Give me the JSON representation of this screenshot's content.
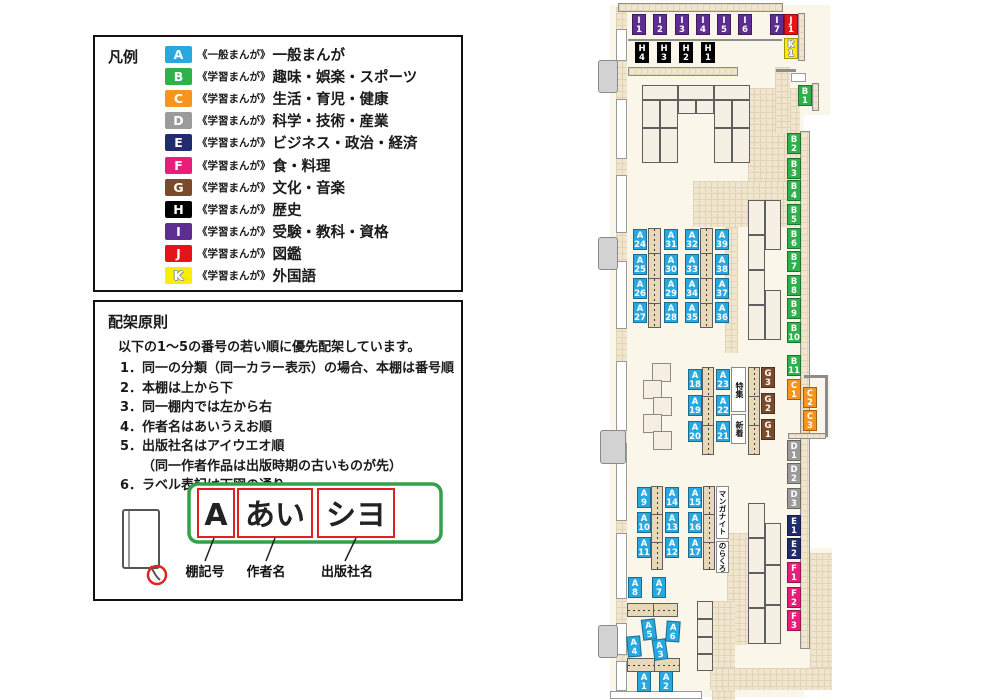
{
  "legend": {
    "title": "凡例",
    "items": [
      {
        "code": "A",
        "color": "#29a8e0",
        "type": "《一般まんが》",
        "category": "一般まんが"
      },
      {
        "code": "B",
        "color": "#2eb14b",
        "type": "《学習まんが》",
        "category": "趣味・娯楽・スポーツ"
      },
      {
        "code": "C",
        "color": "#f7941d",
        "type": "《学習まんが》",
        "category": "生活・育児・健康"
      },
      {
        "code": "D",
        "color": "#9b9b9b",
        "type": "《学習まんが》",
        "category": "科学・技術・産業"
      },
      {
        "code": "E",
        "color": "#202c6b",
        "type": "《学習まんが》",
        "category": "ビジネス・政治・経済"
      },
      {
        "code": "F",
        "color": "#e81f7a",
        "type": "《学習まんが》",
        "category": "食・料理"
      },
      {
        "code": "G",
        "color": "#7b4a2b",
        "type": "《学習まんが》",
        "category": "文化・音楽"
      },
      {
        "code": "H",
        "color": "#000000",
        "type": "《学習まんが》",
        "category": "歴史"
      },
      {
        "code": "I",
        "color": "#5e2d91",
        "type": "《学習まんが》",
        "category": "受験・教科・資格"
      },
      {
        "code": "J",
        "color": "#e7131b",
        "type": "《学習まんが》",
        "category": "図鑑"
      },
      {
        "code": "K",
        "color": "#f9ee00",
        "type": "《学習まんが》",
        "category": "外国語"
      }
    ]
  },
  "principles": {
    "title": "配架原則",
    "intro": "以下の1～5の番号の若い順に優先配架しています。",
    "rules": [
      {
        "num": "1．",
        "text": "同一の分類（同一カラー表示）の場合、本棚は番号順"
      },
      {
        "num": "2．",
        "text": "本棚は上から下"
      },
      {
        "num": "3．",
        "text": "同一棚内では左から右"
      },
      {
        "num": "4．",
        "text": "作者名はあいうえお順"
      },
      {
        "num": "5．",
        "text": "出版社名はアイウエオ順",
        "note": "（同一作者作品は出版時期の古いものが先）"
      },
      {
        "num": "6．",
        "text": "ラベル表記は下図の通り"
      }
    ]
  },
  "label_diagram": {
    "boxes": [
      "A",
      "あい",
      "シヨ"
    ],
    "captions": [
      "棚記号",
      "作者名",
      "出版社名"
    ]
  },
  "map": {
    "area_labels": [
      "特集",
      "新着",
      "マンガナイト",
      "のらくろ"
    ],
    "shelf_labels": [
      "A1",
      "A2",
      "A3",
      "A4",
      "A5",
      "A6",
      "A7",
      "A8",
      "A9",
      "A10",
      "A11",
      "A12",
      "A13",
      "A14",
      "A15",
      "A16",
      "A17",
      "A18",
      "A19",
      "A20",
      "A21",
      "A22",
      "A23",
      "A24",
      "A25",
      "A26",
      "A27",
      "A28",
      "A29",
      "A30",
      "A31",
      "A32",
      "A33",
      "A34",
      "A35",
      "A36",
      "A37",
      "A38",
      "A39",
      "B1",
      "B2",
      "B3",
      "B4",
      "B5",
      "B6",
      "B7",
      "B8",
      "B9",
      "B10",
      "B11",
      "C1",
      "C2",
      "C3",
      "D1",
      "D2",
      "D3",
      "E1",
      "E2",
      "F1",
      "F2",
      "F3",
      "G1",
      "G2",
      "G3",
      "H1",
      "H2",
      "H3",
      "H4",
      "I1",
      "I2",
      "I3",
      "I4",
      "I5",
      "I6",
      "I7",
      "J1",
      "K1"
    ]
  }
}
